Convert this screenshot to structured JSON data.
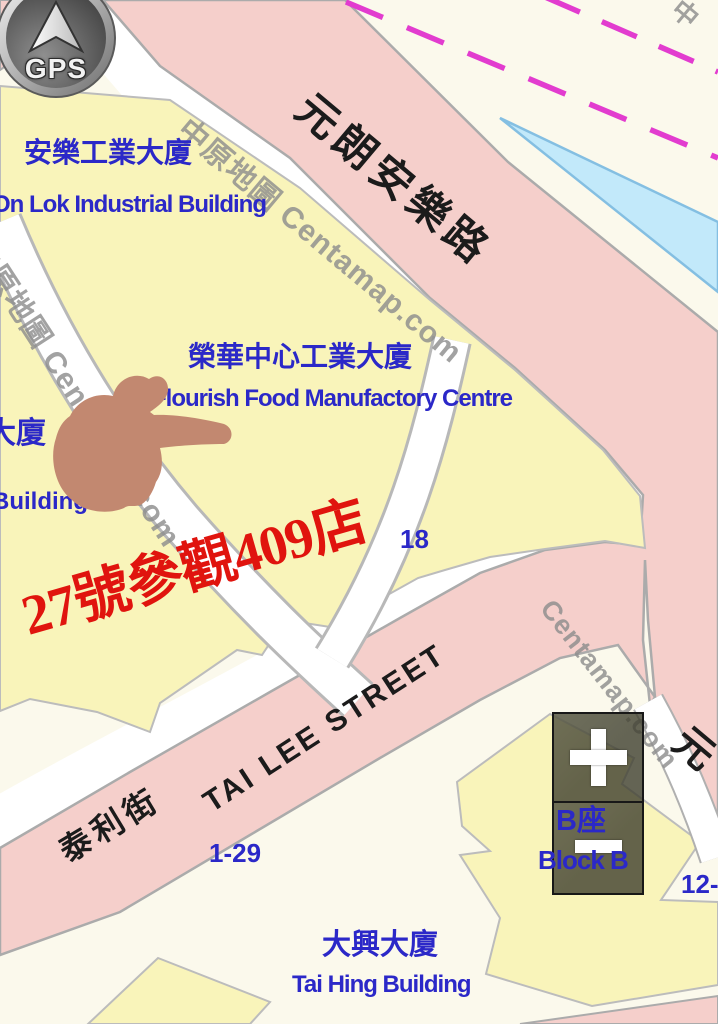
{
  "map": {
    "buildings": {
      "on_lok_zh": "安樂工業大廈",
      "on_lok_en": "On Lok Industrial Building",
      "flourish_zh": "榮華中心工業大廈",
      "flourish_en": "Flourish Food Manufactory Centre",
      "tai_hing_zh": "大興大廈",
      "tai_hing_en": "Tai Hing Building",
      "block_b_zh": "B座",
      "block_b_en": "Block B",
      "partial_left_zh": "大廈",
      "partial_left_en": "Building"
    },
    "roads": {
      "yuen_long_on_lok_road": "元朗安樂路",
      "tai_lee_street_en": "TAI LEE STREET",
      "tai_lee_street_zh": "泰利街",
      "partial_road_char": "元"
    },
    "numbers": {
      "lot_18": "18",
      "range_1_29": "1-29",
      "range_12": "12-"
    },
    "watermark": {
      "line_full": "中原地圖 Centamap.com",
      "line_short": "Centamap.com",
      "corner_partial": "中"
    },
    "annotations": {
      "red_note": "27號參觀409店"
    },
    "colors": {
      "building_fill": "#F9F4BA",
      "road_fill": "#F5CFCB",
      "background_cream": "#FBF9EC",
      "water_fill": "#C2E9FA",
      "label_blue": "#2B28C8",
      "road_label_black": "#1B1B1B",
      "annotation_red": "#E0140E",
      "boundary_magenta": "#E23CCF",
      "watermark_gray": "#8E8E8E",
      "hand_tan": "#C28870"
    }
  },
  "controls": {
    "gps_label": "GPS",
    "zoom_in_icon": "plus",
    "zoom_out_icon": "minus"
  }
}
